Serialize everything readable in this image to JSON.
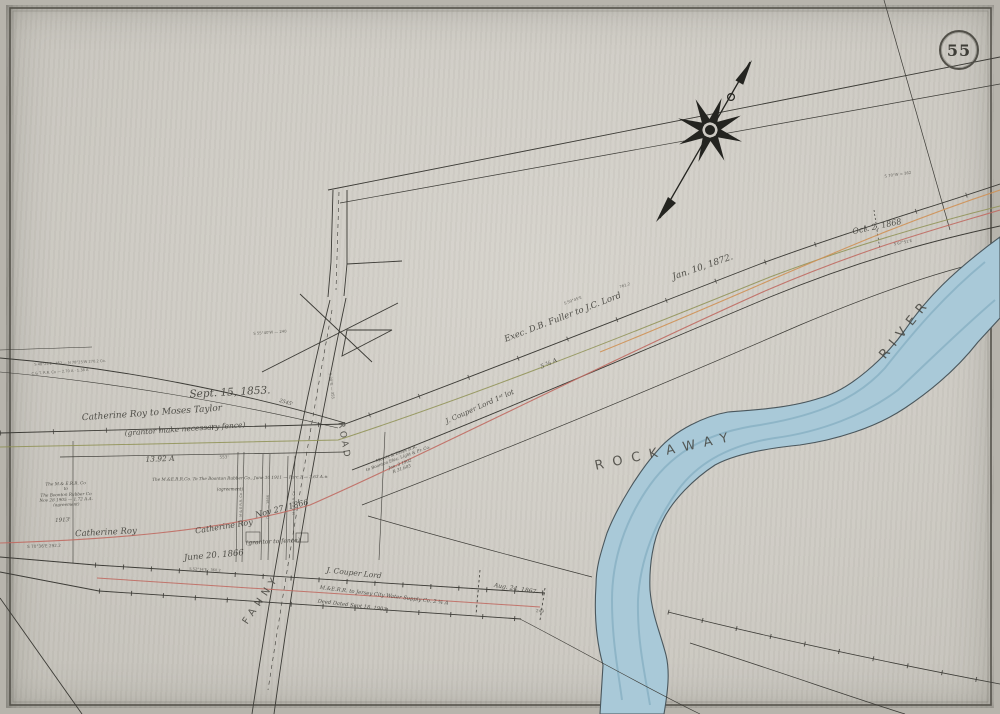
{
  "sheet": {
    "number": "55",
    "type": "railroad right-of-way survey map"
  },
  "colors": {
    "paper": "#cdcac3",
    "paper_dark": "#b7b4ac",
    "ink": "#3c3b36",
    "ink_text": "#45443e",
    "red_line": "#c06a62",
    "green_line": "#8e9052",
    "orange_line": "#cf9054",
    "river_fill": "#a9c9d8",
    "river_streak": "#84adc0",
    "river_edge": "#4a575d"
  },
  "river": {
    "name": "Rockaway River"
  },
  "compass": {
    "name": "north-arrow-compass-rose"
  },
  "labels": [
    {
      "name": "date-sept-1853",
      "text": "Sept. 15, 1853.",
      "x": 230,
      "y": 393,
      "rot": -3,
      "size": 10.5
    },
    {
      "name": "deed-roy-to-taylor",
      "text": "Catherine Roy to Moses Taylor",
      "x": 152,
      "y": 414,
      "rot": -4,
      "size": 9
    },
    {
      "name": "deed-roy-taylor-note",
      "text": "(grantor make necessary fence)",
      "x": 185,
      "y": 429,
      "rot": -4,
      "size": 7.5
    },
    {
      "name": "acreage-13",
      "text": "13.92 A",
      "x": 160,
      "y": 459,
      "rot": -2,
      "size": 7.5
    },
    {
      "name": "deed-rubber-co-block",
      "text": "The M.& E.R.R. Co\nto\nThe Boonton Rubber Co\nNov 28 1905 — 1.72 A.A.\n(agreement)",
      "x": 66,
      "y": 494,
      "rot": -2,
      "size": 4.2
    },
    {
      "name": "deed-rubber-co-line",
      "text": "The M.&E.R.R.Co. To The Boonton Rubber Co., June 30 1911 — Parc.1 — 3.63 A.±",
      "x": 240,
      "y": 478,
      "rot": -1,
      "size": 4.2
    },
    {
      "name": "deed-rubber-co-note",
      "text": "(agreement)",
      "x": 230,
      "y": 489,
      "rot": 0,
      "size": 4.2
    },
    {
      "name": "owner-catherine-roy",
      "text": "Catherine Roy",
      "x": 106,
      "y": 533,
      "rot": -3,
      "size": 8.5
    },
    {
      "name": "roy-fence-note",
      "text": "(grantor to fence)",
      "x": 273,
      "y": 542,
      "rot": -3,
      "size": 6
    },
    {
      "name": "owner-catherine-roy-2",
      "text": "Catherine Roy",
      "x": 224,
      "y": 527,
      "rot": -9,
      "size": 8
    },
    {
      "name": "date-nov-1866",
      "text": "Nov 27. 1866",
      "x": 282,
      "y": 509,
      "rot": -14,
      "size": 8
    },
    {
      "name": "date-june-1866",
      "text": "June 20. 1866",
      "x": 214,
      "y": 556,
      "rot": -5,
      "size": 8.5
    },
    {
      "name": "dist-1913",
      "text": "1913'",
      "x": 63,
      "y": 521,
      "rot": -3,
      "size": 5.5
    },
    {
      "name": "bearing-left-strip",
      "text": "S 70°36'E   292.2",
      "x": 44,
      "y": 546,
      "rot": -2,
      "size": 4.2,
      "cls": "tiny"
    },
    {
      "name": "bearing-left-strip-2",
      "text": "S 52°34'E · 360.2",
      "x": 205,
      "y": 570,
      "rot": 3,
      "size": 3.6,
      "cls": "tiny"
    },
    {
      "name": "owner-couper-lord-strip",
      "text": "J. Couper    Lord",
      "x": 354,
      "y": 573,
      "rot": 6,
      "size": 7.5
    },
    {
      "name": "deed-water-supply",
      "text": "M.&E.R.R. to Jersey City Water Supply Co.  2 ¾ A",
      "x": 384,
      "y": 596,
      "rot": 7,
      "size": 5.2
    },
    {
      "name": "deed-water-supply-date",
      "text": "Deed Dated Sept 18, 1903",
      "x": 352,
      "y": 606,
      "rot": 7,
      "size": 5.2
    },
    {
      "name": "date-aug-1867",
      "text": "Aug. 24, 1867",
      "x": 515,
      "y": 589,
      "rot": 9,
      "size": 6
    },
    {
      "name": "dist-249",
      "text": "249",
      "x": 540,
      "y": 611,
      "rot": 4,
      "size": 4.2,
      "cls": "tiny"
    },
    {
      "name": "road-label-fanny",
      "text": "FANNY",
      "x": 262,
      "y": 600,
      "rot": -56,
      "size": 10,
      "ls": 5,
      "cls": "caps"
    },
    {
      "name": "road-label-road",
      "text": "ROAD",
      "x": 343,
      "y": 441,
      "rot": 80,
      "size": 9,
      "ls": 3,
      "cls": "caps"
    },
    {
      "name": "deed-electric-block",
      "text": "Morris & Essex R.R.\nto Boonton Elec. Light & Pr. Co.\nJan. 3 1902\nR 31.603",
      "x": 399,
      "y": 461,
      "rot": -20,
      "size": 4.2
    },
    {
      "name": "owner-couper-lord-1st-lot",
      "text": "J. Couper   Lord   1ˢᵗ lot",
      "x": 480,
      "y": 407,
      "rot": -24,
      "size": 7
    },
    {
      "name": "acreage-5",
      "text": "5 ¾ A",
      "x": 549,
      "y": 364,
      "rot": -24,
      "size": 6
    },
    {
      "name": "deed-fuller-to-lord",
      "text": "Exec. D.B. Fuller to J.C. Lord",
      "x": 563,
      "y": 318,
      "rot": -21,
      "size": 8.5
    },
    {
      "name": "bearing-s5945e",
      "text": "S 59°45'E",
      "x": 573,
      "y": 301,
      "rot": -20,
      "size": 3.8,
      "cls": "tiny"
    },
    {
      "name": "dist-7612",
      "text": "761.2",
      "x": 625,
      "y": 286,
      "rot": -18,
      "size": 3.8,
      "cls": "tiny"
    },
    {
      "name": "date-jan-1872",
      "text": "Jan. 10, 1872.",
      "x": 703,
      "y": 268,
      "rot": -19,
      "size": 9
    },
    {
      "name": "date-oct-1868",
      "text": "Oct. 2, 1868",
      "x": 877,
      "y": 227,
      "rot": -12,
      "size": 8
    },
    {
      "name": "bearing-s6751e",
      "text": "S 67°51'E",
      "x": 903,
      "y": 243,
      "rot": -11,
      "size": 3.8,
      "cls": "tiny"
    },
    {
      "name": "bearing-s70w",
      "text": "S 70°W = 362",
      "x": 898,
      "y": 175,
      "rot": -8,
      "size": 3.8,
      "cls": "tiny"
    },
    {
      "name": "river-label-rockaway",
      "text": "ROCKAWAY",
      "x": 666,
      "y": 452,
      "rot": -12,
      "size": 13,
      "ls": 9,
      "cls": "caps"
    },
    {
      "name": "river-label-river",
      "text": "RIVER",
      "x": 906,
      "y": 329,
      "rot": -51,
      "size": 13,
      "ls": 7,
      "cls": "caps"
    },
    {
      "name": "dist-2545",
      "text": "2545'",
      "x": 286,
      "y": 403,
      "rot": 16,
      "size": 5
    },
    {
      "name": "bearing-s5540w",
      "text": "S 55°40'W — 240",
      "x": 270,
      "y": 333,
      "rot": -4,
      "size": 3.8,
      "cls": "tiny"
    },
    {
      "name": "bearing-s30e",
      "text": "S 30°E — 355",
      "x": 331,
      "y": 386,
      "rot": 83,
      "size": 3.8,
      "cls": "tiny"
    },
    {
      "name": "tiny-annotation-left-1",
      "text": "S 48°25'E · 352 — N 78°25'W 270.2 Co.",
      "x": 70,
      "y": 363,
      "rot": -3,
      "size": 3.6,
      "cls": "tiny"
    },
    {
      "name": "tiny-annotation-left-2",
      "text": "C.& T. R.R. Co — 2.70 A · 1.38 A",
      "x": 60,
      "y": 372,
      "rot": -4,
      "size": 3.6,
      "cls": "tiny"
    },
    {
      "name": "dist-553",
      "text": "553'",
      "x": 224,
      "y": 457,
      "rot": -1,
      "size": 4.2,
      "cls": "tiny"
    },
    {
      "name": "parcel-note-1",
      "text": "M & E R.R. Co",
      "x": 241,
      "y": 505,
      "rot": -90,
      "size": 3.5,
      "cls": "tiny"
    },
    {
      "name": "parcel-note-2",
      "text": "Deed — 1866",
      "x": 268,
      "y": 507,
      "rot": -90,
      "size": 3.5,
      "cls": "tiny"
    },
    {
      "name": "parcel-note-3",
      "text": "M & E R.R. Co",
      "x": 294,
      "y": 503,
      "rot": -90,
      "size": 3.5,
      "cls": "tiny"
    }
  ]
}
